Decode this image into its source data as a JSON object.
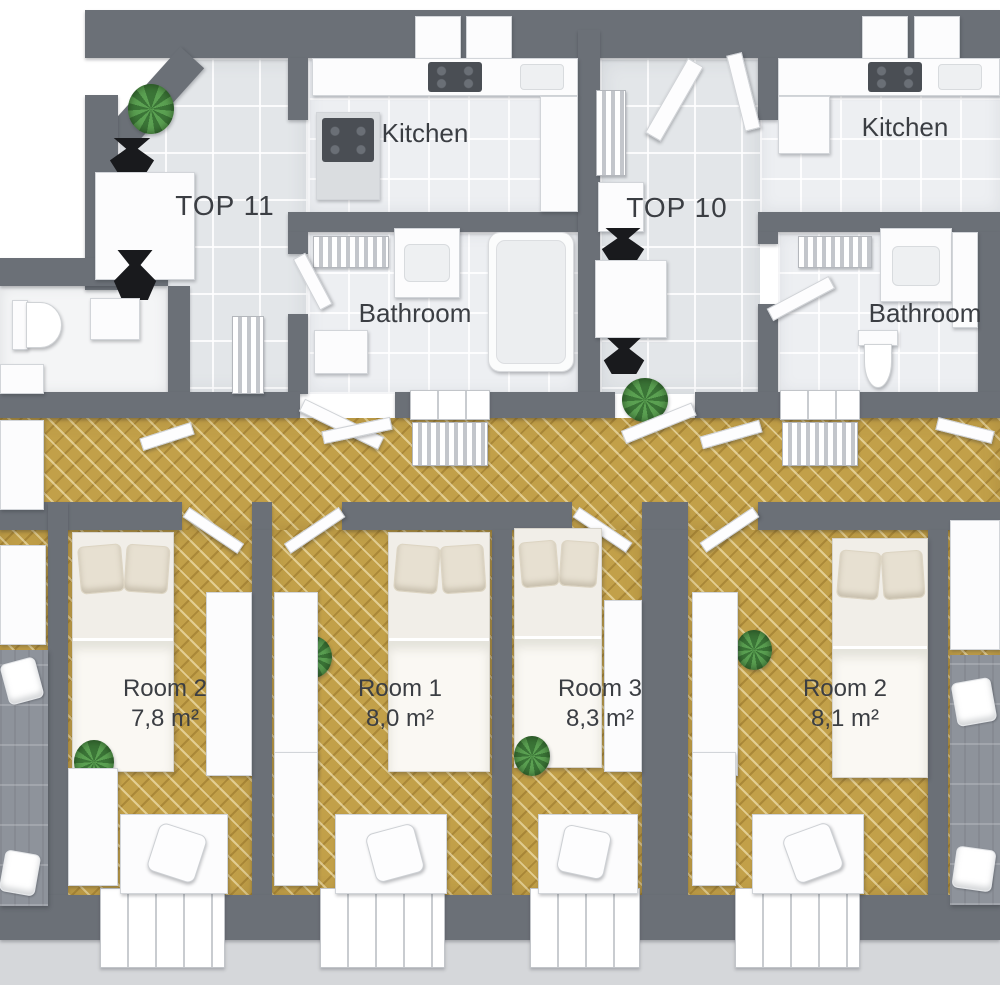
{
  "colors": {
    "wall": "#6b7077",
    "tile": "#e3e6e9",
    "tile-light": "#edeff2",
    "parquet": "#c2a049",
    "exterior": "#d5d7da",
    "furniture": "#fcfcfd",
    "blanket": "#faf8f3",
    "pillow-beige": "#e7e0d1",
    "sofa": "#8e939b",
    "plant-dark": "#3b7537",
    "plant-light": "#5ba152",
    "vase": "#191a1d",
    "text": "#3b3e43"
  },
  "apartments": [
    {
      "label": "TOP 11",
      "kitchen": "Kitchen",
      "bathroom": "Bathroom"
    },
    {
      "label": "TOP 10",
      "kitchen": "Kitchen",
      "bathroom": "Bathroom"
    }
  ],
  "bedrooms": [
    {
      "name": "Room 2",
      "area": "7,8 m²"
    },
    {
      "name": "Room 1",
      "area": "8,0 m²"
    },
    {
      "name": "Room 3",
      "area": "8,3 m²"
    },
    {
      "name": "Room 2",
      "area": "8,1 m²"
    }
  ]
}
